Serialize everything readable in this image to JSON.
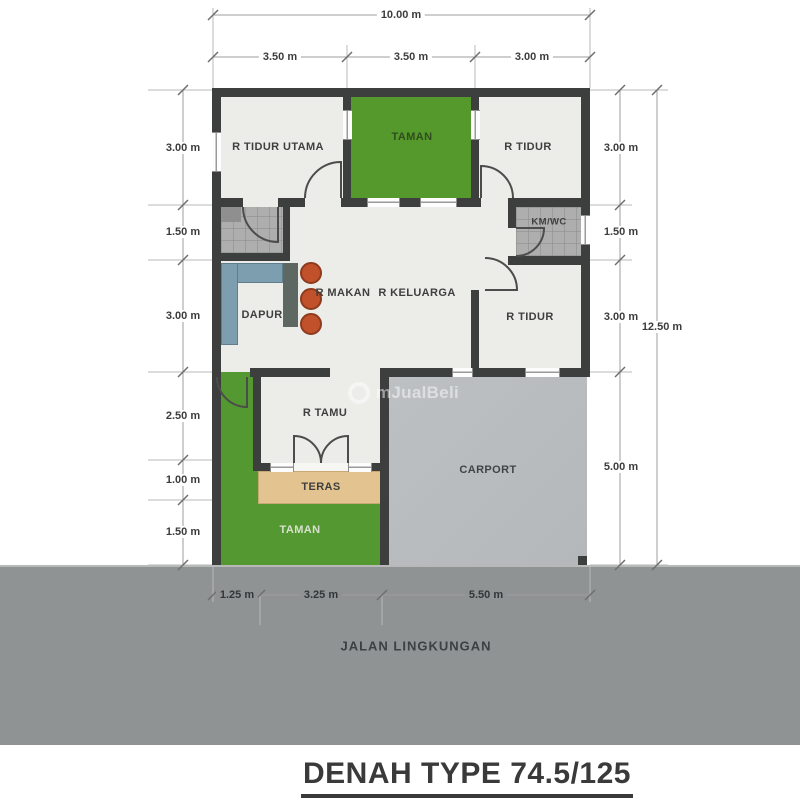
{
  "title": "DENAH TYPE 74.5/125",
  "road": {
    "label": "JALAN LINGKUNGAN"
  },
  "watermark": {
    "text": "mJualBeli"
  },
  "dimensions": {
    "top_total": "10.00 m",
    "top_segments": [
      "3.50 m",
      "3.50 m",
      "3.00 m"
    ],
    "left_segments": [
      "3.00 m",
      "1.50 m",
      "3.00 m",
      "2.50 m",
      "1.00 m",
      "1.50 m"
    ],
    "right_segments": [
      "3.00 m",
      "1.50 m",
      "3.00 m",
      "5.00 m"
    ],
    "right_total": "12.50 m",
    "bottom_segments": [
      "1.25 m",
      "3.25 m",
      "5.50 m"
    ]
  },
  "rooms": {
    "r_tidur_utama": "R TIDUR UTAMA",
    "taman_top": "TAMAN",
    "r_tidur_top": "R TIDUR",
    "km_wc": "KM/WC",
    "dapur": "DAPUR",
    "r_makan": "R MAKAN",
    "r_keluarga": "R KELUARGA",
    "r_tidur_mid": "R TIDUR",
    "r_tamu": "R TAMU",
    "carport": "CARPORT",
    "teras": "TERAS",
    "taman_bottom": "TAMAN"
  },
  "colors": {
    "wall": "#3d3e3e",
    "floor": "#ecede8",
    "garden_green": "#549831",
    "carport_gray": "#b9bdbf",
    "road_gray": "#8f9394",
    "teras_tan": "#e3c38f",
    "kitchen_counter_blue": "#7d9eae",
    "bar_counter": "#5e6862",
    "stool_orange": "#c1512a"
  }
}
